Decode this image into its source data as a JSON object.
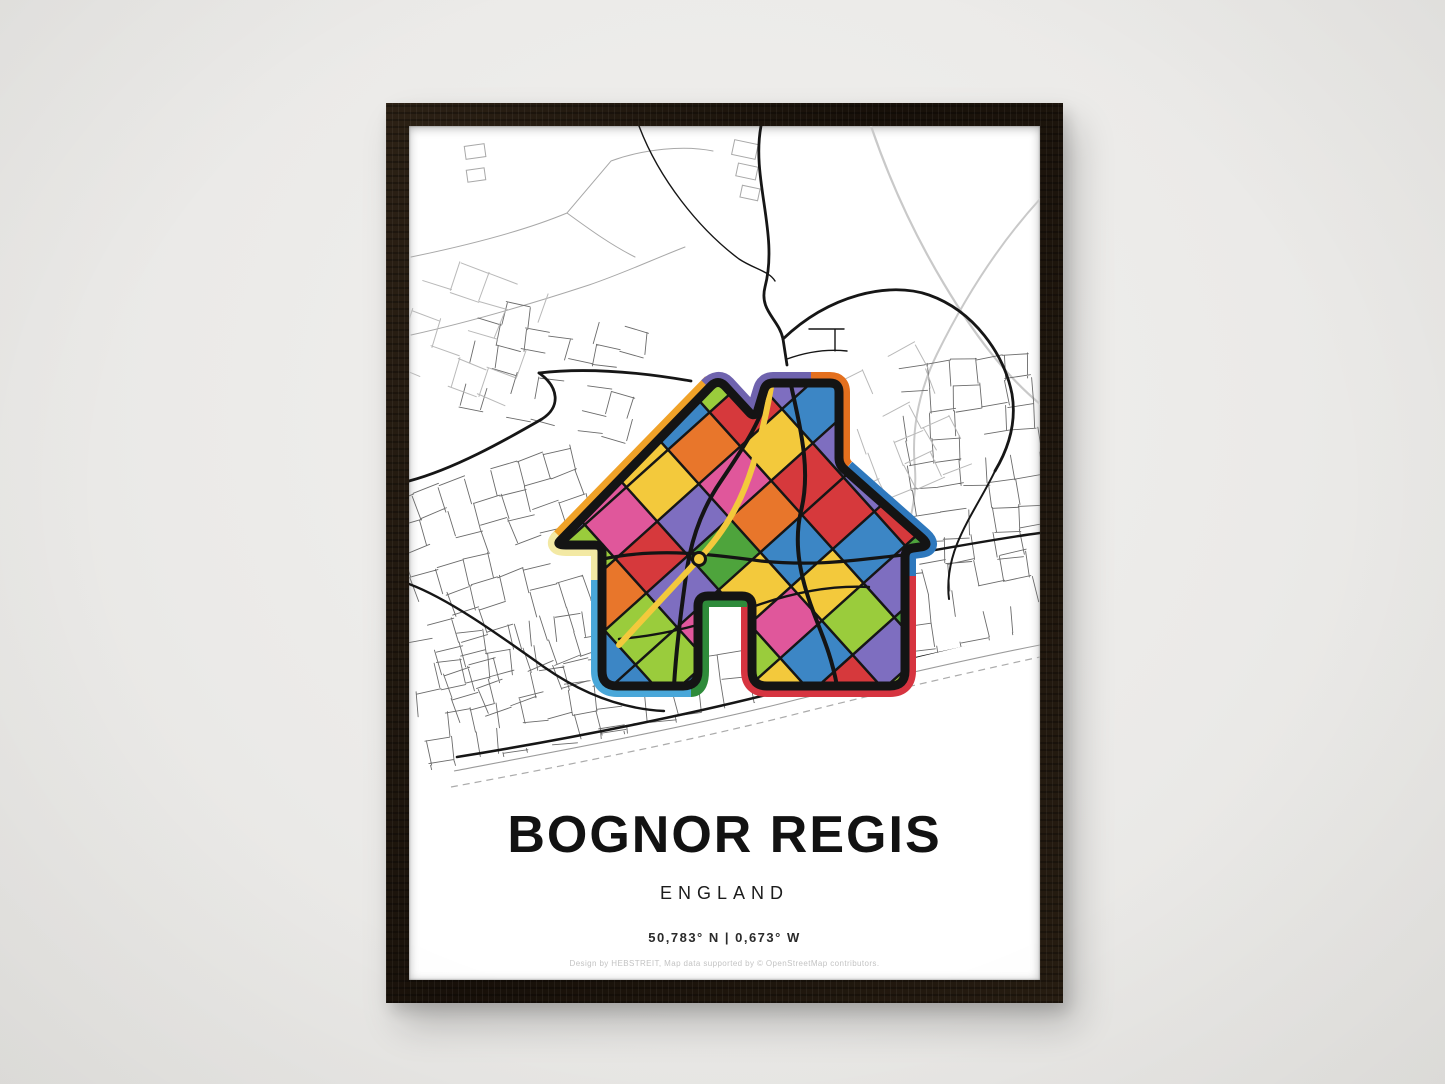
{
  "scene": {
    "wall_color": "#ebeae8"
  },
  "poster": {
    "title": "BOGNOR REGIS",
    "subtitle": "ENGLAND",
    "coordinates": "50,783° N | 0,673° W",
    "credit": "Design by HEBSTREIT, Map data supported by © OpenStreetMap contributors.",
    "frame_color": "#1d140c",
    "paper_color": "#ffffff"
  },
  "map": {
    "type": "street-map",
    "location": "Bognor Regis, England",
    "road_color": "#161616",
    "street_color": "#6b6b6b",
    "street_light_color": "#b9b9b9",
    "coastline_style": "dashed"
  },
  "house_graphic": {
    "name": "colorful-house-map-overlay",
    "outline_color": "#141414",
    "border_segments": [
      {
        "name": "left-roof",
        "color": "#f0a228"
      },
      {
        "name": "roof-apex",
        "color": "#6f63ae"
      },
      {
        "name": "chimney-right",
        "color": "#e4701e"
      },
      {
        "name": "right-roof",
        "color": "#2e78bd"
      },
      {
        "name": "right-leg",
        "color": "#d63440"
      },
      {
        "name": "door-arch",
        "color": "#2e8b3a"
      },
      {
        "name": "left-leg",
        "color": "#49a7d9"
      },
      {
        "name": "left-wall",
        "color": "#f3e9a4"
      }
    ],
    "fill_palette": [
      "#d6393c",
      "#3c86c5",
      "#e8762b",
      "#f3c93c",
      "#4ea43c",
      "#e0579b",
      "#7e6ec0",
      "#9acc3c"
    ]
  }
}
